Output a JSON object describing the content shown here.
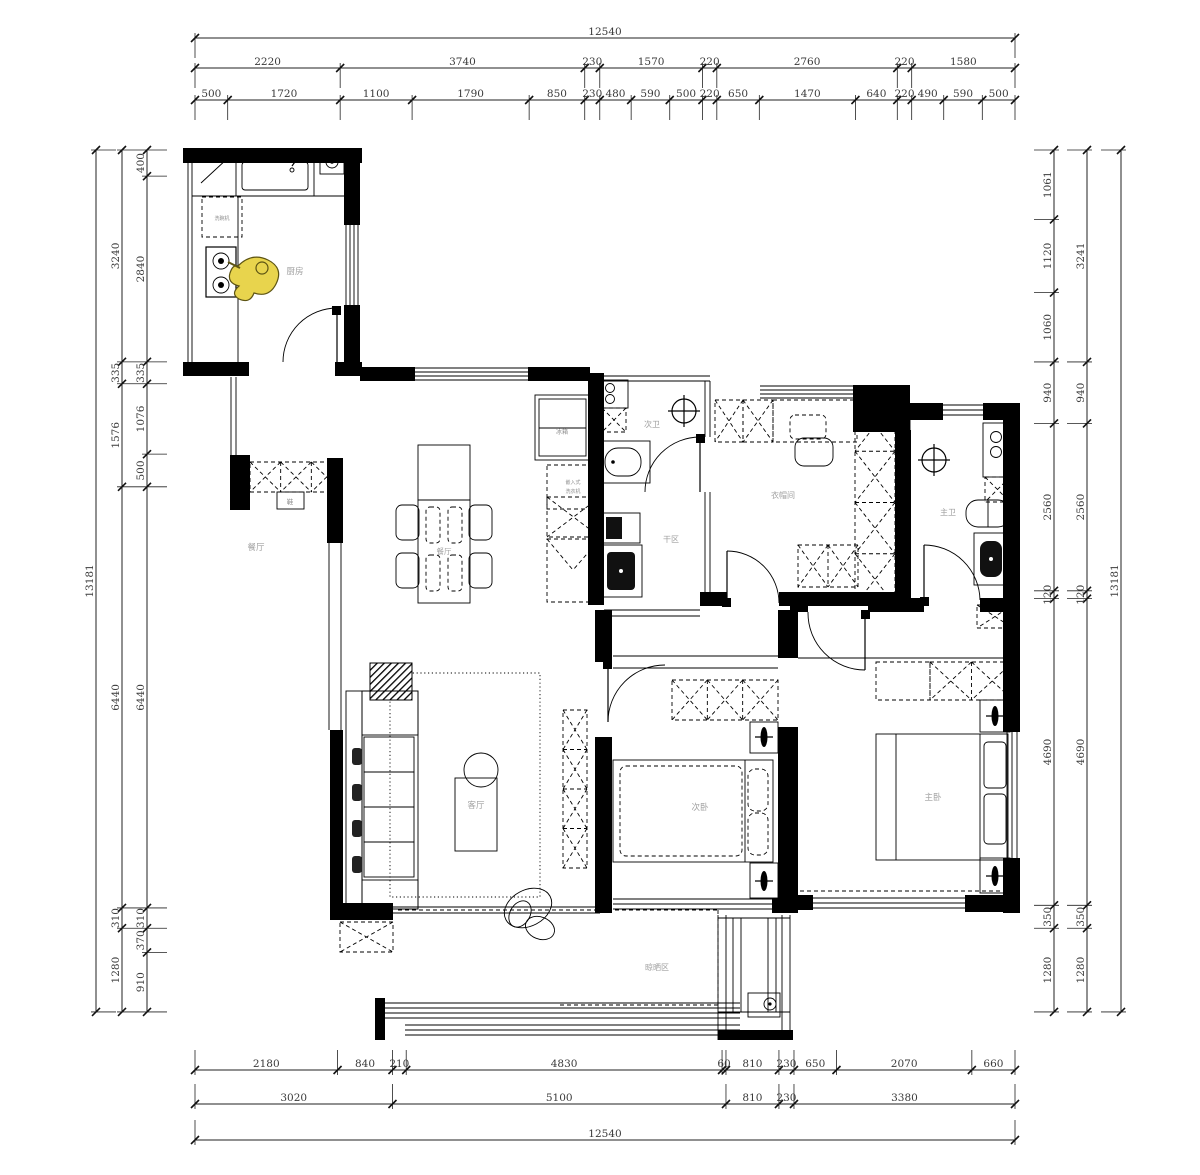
{
  "plan": {
    "overall_width_mm": "12540",
    "overall_height_mm": "13181",
    "rooms": {
      "kitchen": "厨房",
      "dining_west": "餐厅",
      "dining_table": "餐厅",
      "living": "客厅",
      "second_bath": "次卫",
      "dry_area": "干区",
      "cloakroom": "衣帽间",
      "master_bath": "主卫",
      "second_bedroom": "次卧",
      "master_bedroom": "主卧",
      "balcony": "晾晒区"
    },
    "fixtures": {
      "fridge": "冰箱",
      "dishwasher": "洗碗机",
      "washer_line1": "嵌入式",
      "washer_line2": "洗衣机",
      "shoe_cabinet": "鞋"
    }
  },
  "dimensions": {
    "top": [
      [
        12540
      ],
      [
        2220,
        3740,
        230,
        1570,
        220,
        2760,
        220,
        1580
      ],
      [
        500,
        1720,
        1100,
        1790,
        850,
        230,
        480,
        590,
        500,
        220,
        650,
        1470,
        640,
        220,
        490,
        590,
        500
      ]
    ],
    "bottom": [
      [
        2180,
        840,
        210,
        4830,
        60,
        810,
        230,
        650,
        2070,
        660
      ],
      [
        3020,
        5100,
        810,
        230,
        3380
      ],
      [
        12540
      ]
    ],
    "left": [
      [
        13181
      ],
      [
        3240,
        335,
        1576,
        6440,
        310,
        1280
      ],
      [
        400,
        2840,
        335,
        1076,
        500,
        6440,
        310,
        370,
        910
      ]
    ],
    "right": [
      [
        1061,
        1120,
        1060,
        940,
        2560,
        120,
        4690,
        350,
        1280
      ],
      [
        3241,
        940,
        2560,
        120,
        4690,
        350,
        1280
      ],
      [
        13181
      ]
    ]
  },
  "colors": {
    "wall": "#000000",
    "room_label": "#a0a0a0",
    "dimension_text": "#3a3a3a",
    "figure_accent": "#e8d44d"
  }
}
